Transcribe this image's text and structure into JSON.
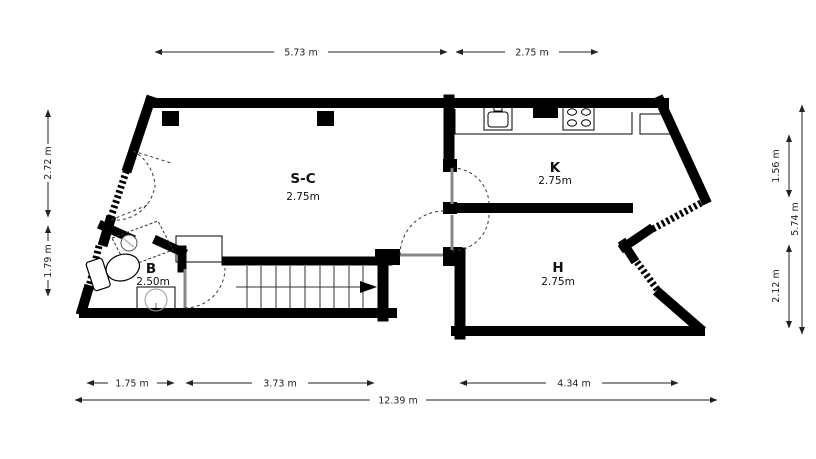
{
  "plan": {
    "type": "floor-plan",
    "rooms": [
      {
        "label": "S-C",
        "size": "2.75m"
      },
      {
        "label": "K",
        "size": "2.75m"
      },
      {
        "label": "B",
        "size": "2.50m"
      },
      {
        "label": "H",
        "size": "2.75m"
      }
    ],
    "dimensions": {
      "top_left_width": "5.73 m",
      "top_right_width": "2.75 m",
      "left_upper_height": "2.72 m",
      "left_lower_height": "1.79 m",
      "right_upper_height": "1.56 m",
      "right_lower_height": "2.12 m",
      "right_total_height": "5.74 m",
      "bottom_bath_width": "1.75 m",
      "bottom_stairs_width": "3.73 m",
      "bottom_room_width": "4.34 m",
      "bottom_total_width": "12.39 m"
    },
    "fixtures": {
      "kitchen": [
        "kitchen-sink",
        "stove-4-burners",
        "counter",
        "appliance"
      ],
      "bathroom": [
        "shower",
        "toilet",
        "washbasin"
      ],
      "stairs": {
        "steps": 10,
        "direction_arrow": "right"
      },
      "structure": [
        "column",
        "column",
        "windows-hatched",
        "door-swings"
      ]
    },
    "colors": {
      "wall": "#000000",
      "background": "#ffffff",
      "dimension_line": "#222222",
      "door_leaf": "#888888"
    }
  }
}
